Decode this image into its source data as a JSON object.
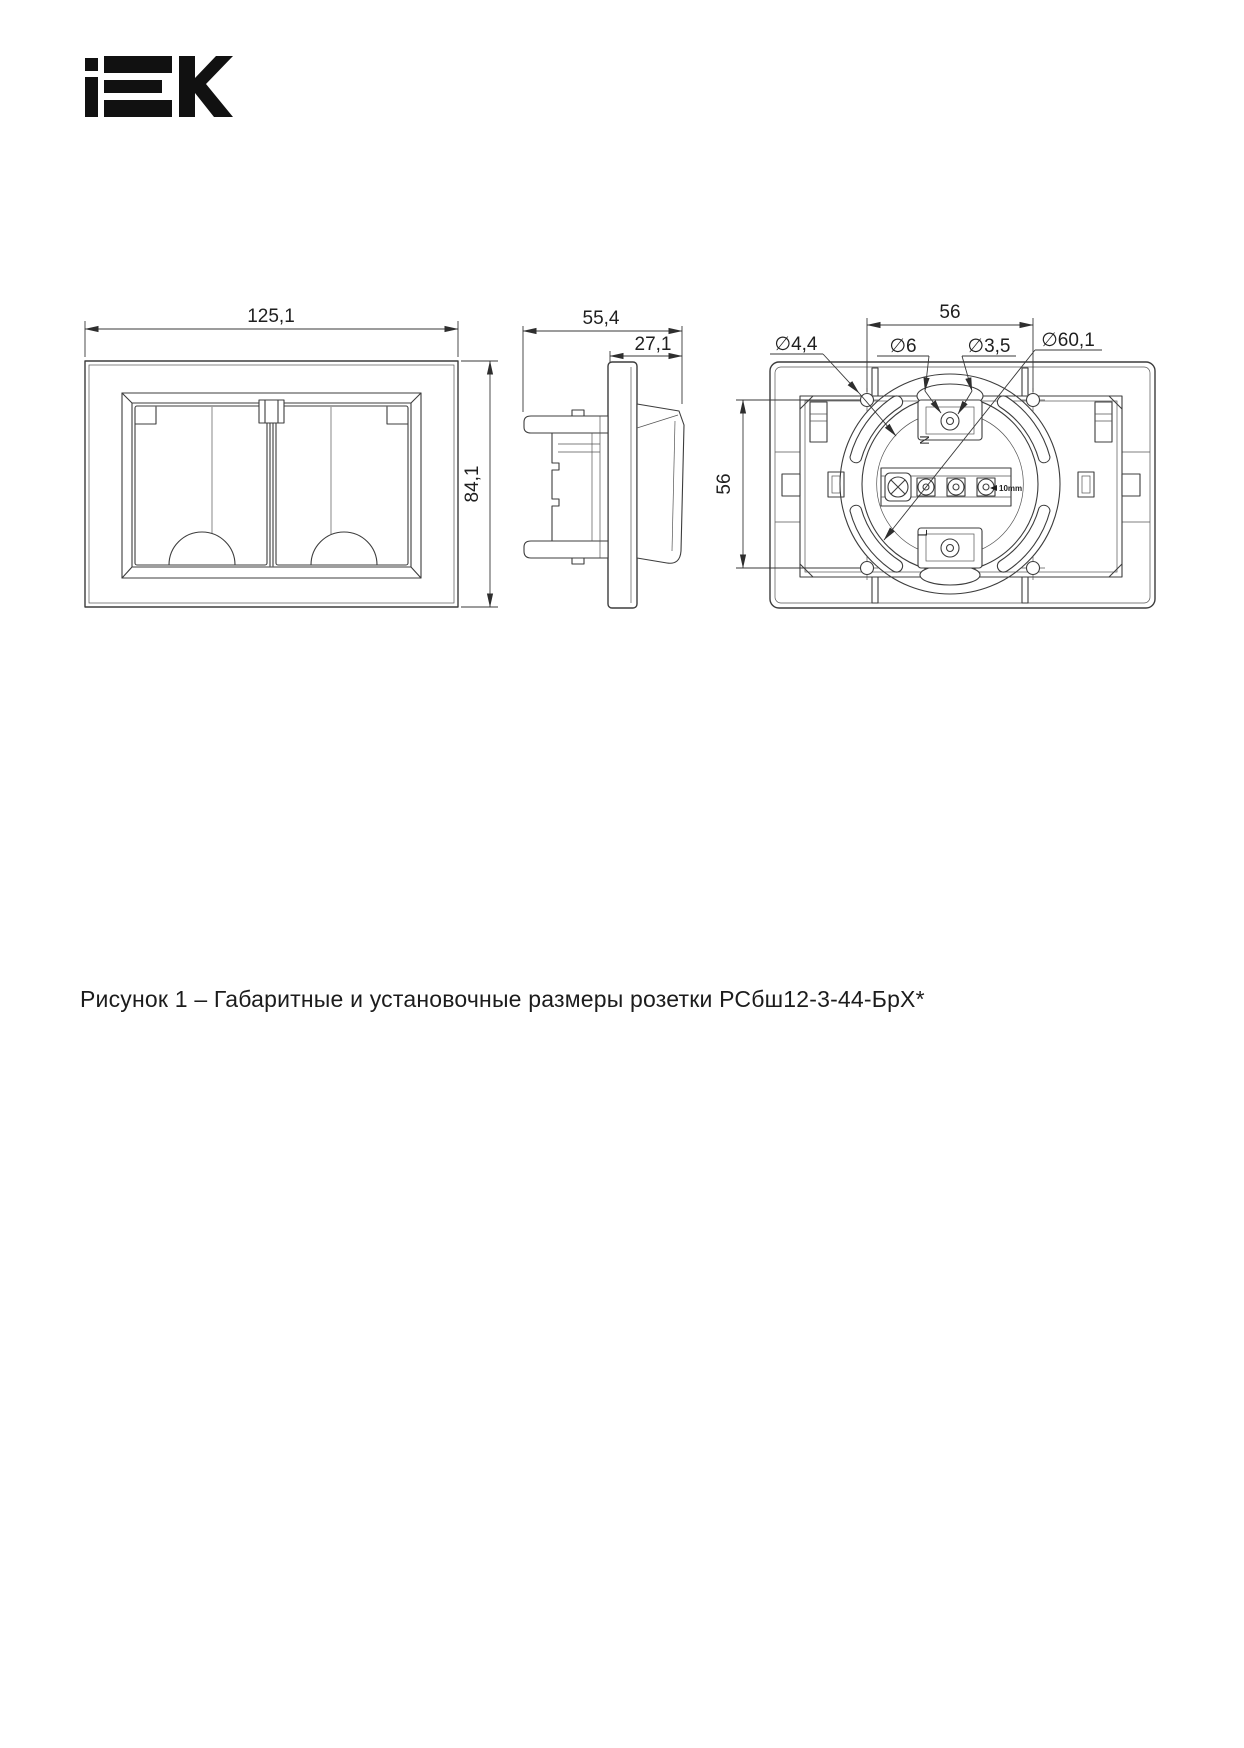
{
  "page": {
    "logo": "IEK",
    "caption": "Рисунок 1 – Габаритные и установочные размеры розетки РСбш12-3-44-БрХ*"
  },
  "front_view": {
    "dim_width": "125,1",
    "dim_height": "84,1"
  },
  "side_view": {
    "dim_depth": "55,4",
    "dim_front_depth": "27,1"
  },
  "back_view": {
    "dim_hole_spacing_h": "56",
    "dim_hole_spacing_v": "56",
    "dia_mounting_hole": "∅4,4",
    "dia_cable_entry": "∅6",
    "dia_screw_hole": "∅3,5",
    "dia_support_ring": "∅60,1",
    "strip_length": "10mm",
    "label_neutral": "N",
    "label_line": "L"
  }
}
